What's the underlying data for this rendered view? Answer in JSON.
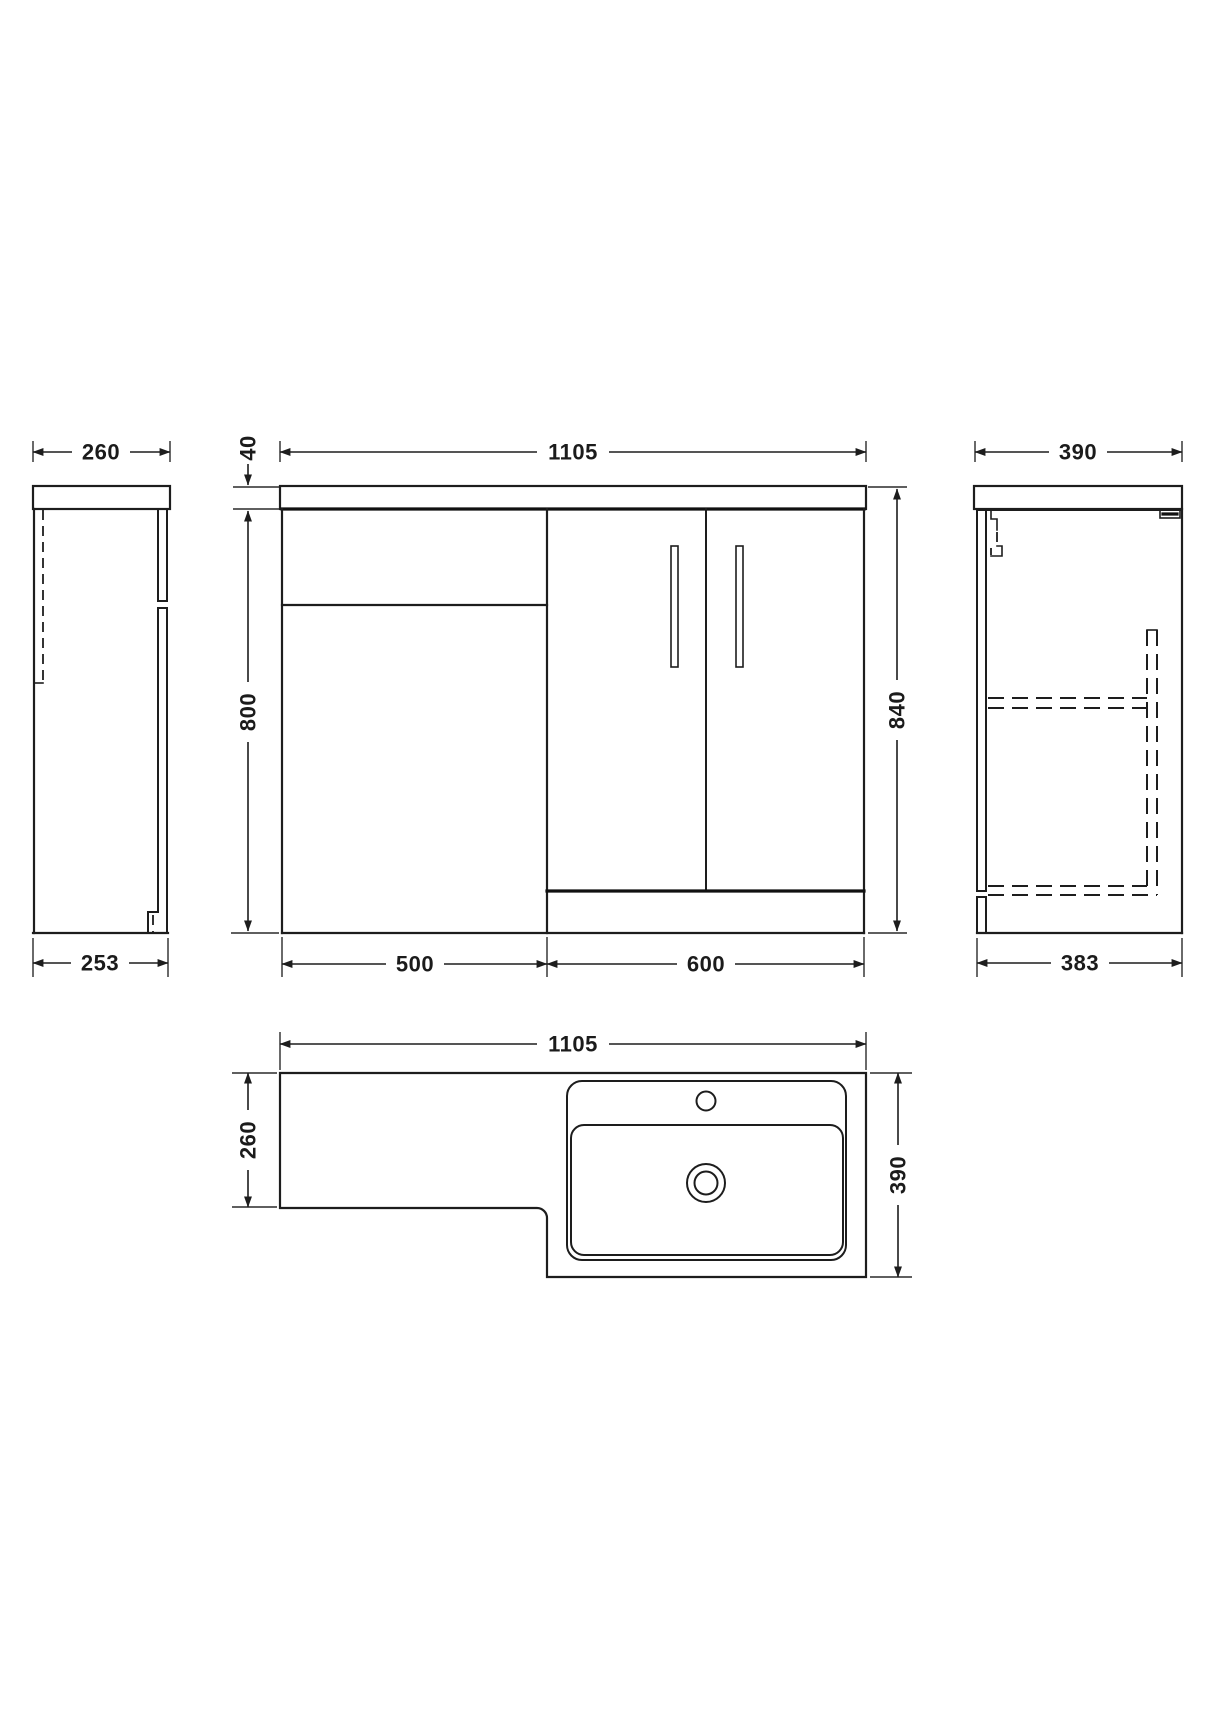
{
  "drawing": {
    "background_color": "#ffffff",
    "line_color": "#1d1d1d",
    "views": {
      "side_left": {
        "dim_depth_top": "260",
        "dim_depth_bottom": "253"
      },
      "front": {
        "dim_width": "1105",
        "dim_counter_thickness": "40",
        "dim_cabinet_height": "800",
        "dim_total_height": "840",
        "dim_wc_unit_width": "500",
        "dim_vanity_width": "600"
      },
      "side_right": {
        "dim_depth_top": "390",
        "dim_depth_bottom": "383"
      },
      "plan": {
        "dim_width": "1105",
        "dim_wc_depth": "260",
        "dim_basin_depth": "390"
      }
    }
  }
}
